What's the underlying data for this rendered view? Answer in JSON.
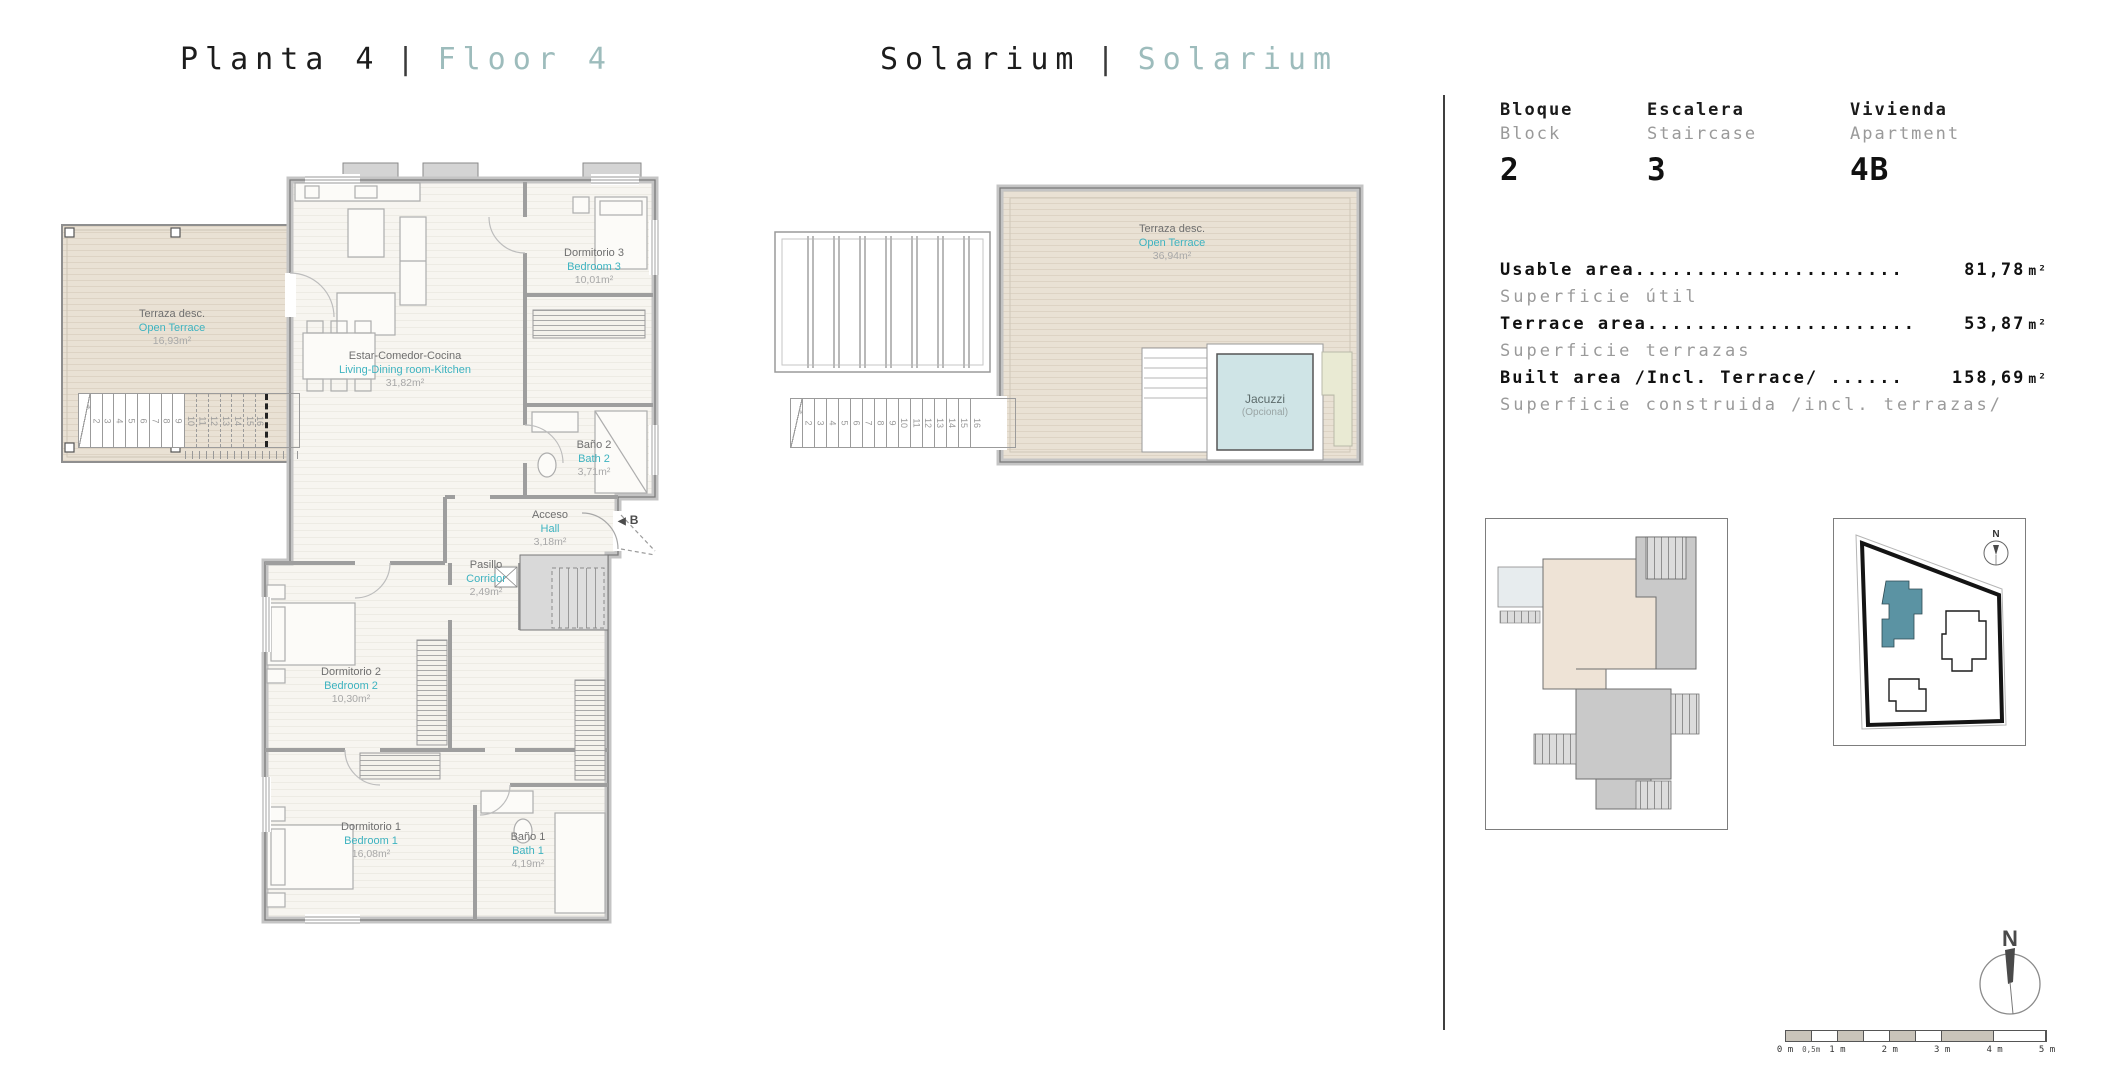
{
  "titles": {
    "left": {
      "primary": "Planta 4",
      "separator": "|",
      "secondary": "Floor 4"
    },
    "right": {
      "primary": "Solarium",
      "separator": "|",
      "secondary": "Solarium"
    }
  },
  "info_panel": {
    "block": {
      "label_es": "Bloque",
      "label_en": "Block",
      "value": "2"
    },
    "staircase": {
      "label_es": "Escalera",
      "label_en": "Staircase",
      "value": "3"
    },
    "apartment": {
      "label_es": "Vivienda",
      "label_en": "Apartment",
      "value": "4B"
    },
    "areas": [
      {
        "label_en": "Usable area......................",
        "label_es": "Superficie útil",
        "value": "81,78",
        "unit": "m²"
      },
      {
        "label_en": "Terrace area......................",
        "label_es": "Superficie terrazas",
        "value": "53,87",
        "unit": "m²"
      },
      {
        "label_en": "Built area /Incl. Terrace/ ......",
        "label_es": "Superficie construida /incl. terrazas/",
        "value": "158,69",
        "unit": "m²"
      }
    ]
  },
  "floor_plan": {
    "rooms": [
      {
        "name_es": "Terraza desc.",
        "name_en": "Open Terrace",
        "area": "16,93m²"
      },
      {
        "name_es": "Dormitorio 3",
        "name_en": "Bedroom 3",
        "area": "10,01m²"
      },
      {
        "name_es": "Estar-Comedor-Cocina",
        "name_en": "Living-Dining room-Kitchen",
        "area": "31,82m²"
      },
      {
        "name_es": "Baño 2",
        "name_en": "Bath 2",
        "area": "3,71m²"
      },
      {
        "name_es": "Acceso",
        "name_en": "Hall",
        "area": "3,18m²"
      },
      {
        "name_es": "Pasillo",
        "name_en": "Corridor",
        "area": "2,49m²"
      },
      {
        "name_es": "Dormitorio 2",
        "name_en": "Bedroom 2",
        "area": "10,30m²"
      },
      {
        "name_es": "Dormitorio 1",
        "name_en": "Bedroom 1",
        "area": "16,08m²"
      },
      {
        "name_es": "Baño 1",
        "name_en": "Bath 1",
        "area": "4,19m²"
      }
    ],
    "entrance_arrow": "◀",
    "entrance_marker": "B"
  },
  "solarium_plan": {
    "terrace": {
      "name_es": "Terraza desc.",
      "name_en": "Open Terrace",
      "area": "36,94m²"
    },
    "jacuzzi": {
      "name": "Jacuzzi",
      "note": "(Opcional)"
    }
  },
  "stairs": {
    "steps": [
      "1",
      "2",
      "3",
      "4",
      "5",
      "6",
      "7",
      "8",
      "9",
      "10",
      "11",
      "12",
      "13",
      "14",
      "15",
      "16"
    ]
  },
  "compass": {
    "label": "N"
  },
  "site_plan": {
    "compass_label": "N"
  },
  "scale_bar": {
    "labels": [
      {
        "text": "0 m",
        "pos": 0
      },
      {
        "text": "0,5m",
        "pos": 10
      },
      {
        "text": "1 m",
        "pos": 20
      },
      {
        "text": "2 m",
        "pos": 40
      },
      {
        "text": "3 m",
        "pos": 60
      },
      {
        "text": "4 m",
        "pos": 80
      },
      {
        "text": "5 m",
        "pos": 100
      }
    ],
    "segments": [
      {
        "from": 0,
        "to": 10,
        "shade": true
      },
      {
        "from": 10,
        "to": 20,
        "shade": false
      },
      {
        "from": 20,
        "to": 30,
        "shade": true
      },
      {
        "from": 30,
        "to": 40,
        "shade": false
      },
      {
        "from": 40,
        "to": 50,
        "shade": true
      },
      {
        "from": 50,
        "to": 60,
        "shade": false
      },
      {
        "from": 60,
        "to": 80,
        "shade": true
      },
      {
        "from": 80,
        "to": 100,
        "shade": false
      }
    ]
  },
  "colors": {
    "accent_teal": "#3eb3c0",
    "title_secondary": "#9dbcbc",
    "deck": "#e9e1d4",
    "jacuzzi_fill": "#cfe4e6",
    "site_highlight": "#5b93a3"
  }
}
